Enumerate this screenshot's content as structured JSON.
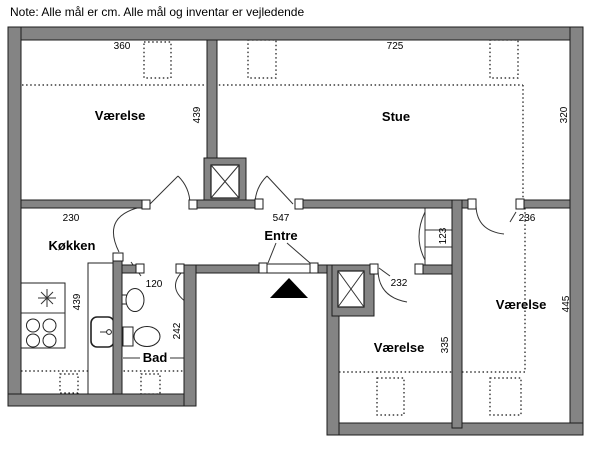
{
  "note": "Note: Alle mål er cm. Alle mål og inventar er vejledende",
  "colors": {
    "wall": "#848484",
    "line": "#1c1c1c",
    "background": "#ffffff",
    "entrance_marker": "#000000"
  },
  "rooms": {
    "bedroom_top_left": {
      "label": "Værelse",
      "width_cm": "360",
      "depth_cm": "439"
    },
    "living_room": {
      "label": "Stue",
      "width_cm": "725",
      "depth_cm": "320"
    },
    "kitchen": {
      "label": "Køkken",
      "wall_cm": "230",
      "length_cm": "439"
    },
    "hall": {
      "label": "Entre",
      "width_cm": "547"
    },
    "bathroom": {
      "label": "Bad",
      "depth_cm": "242",
      "door_cm": "120"
    },
    "bedroom_bottom": {
      "label": "Værelse",
      "depth_cm": "335",
      "door_cm": "232"
    },
    "bedroom_right": {
      "label": "Værelse",
      "depth_cm": "445",
      "door_cm": "236"
    },
    "closet": {
      "width_cm": "123"
    }
  }
}
